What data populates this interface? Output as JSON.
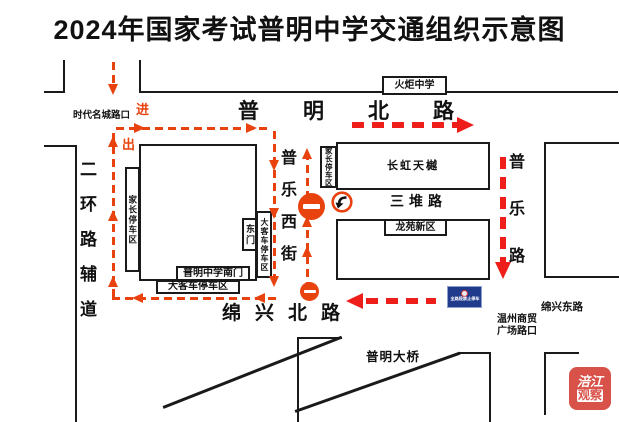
{
  "title": "2024年国家考试普明中学交通组织示意图",
  "map": {
    "roads": {
      "puming_north": "普明北路",
      "erhuan_fudao": "二环路辅道",
      "pule_west_street": "普乐西街",
      "pule_road": "普乐路",
      "sandui_road": "三堆路",
      "mianxing_north": "绵兴北路",
      "mianxing_east": "绵兴东路",
      "puming_bridge": "普明大桥"
    },
    "places": {
      "huoju_school": "火炬中学",
      "changhong_tianyue": "长虹天樾",
      "longyuan_new_district": "龙苑新区",
      "shidai_intersection": "时代名城路口",
      "wenzhou_plaza_line1": "温州商贸",
      "wenzhou_plaza_line2": "广场路口",
      "school_south_gate": "普明中学南门",
      "east_gate": "东门",
      "parent_parking_west": "家长停车区",
      "parent_parking_east": "家长停车区",
      "bus_parking_east": "大客车停车区",
      "bus_parking_south": "大客车停车区"
    },
    "flow": {
      "enter": "进",
      "exit": "出"
    },
    "signs": {
      "no_parking": "全路段禁止停车"
    },
    "watermark": {
      "line1": "涪江",
      "line2": "观察"
    }
  },
  "colors": {
    "route_orange": "#e8430f",
    "route_red": "#ee1f1b",
    "sign_blue": "#203a8c",
    "watermark_red": "#d6453c"
  }
}
